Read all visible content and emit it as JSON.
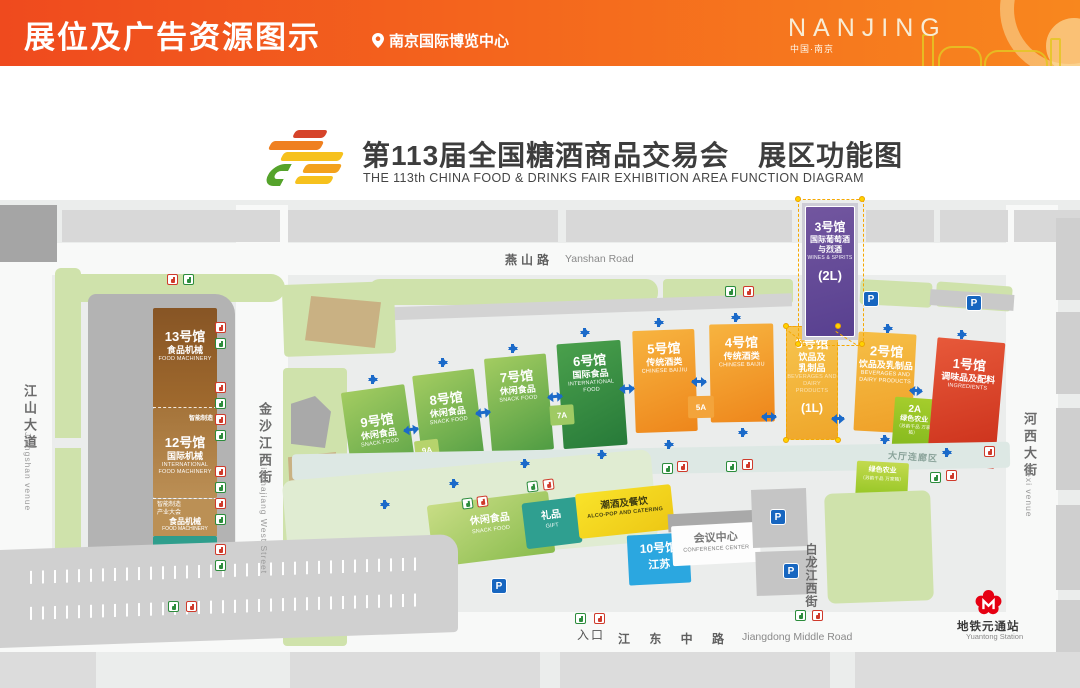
{
  "header": {
    "title": "展位及广告资源图示",
    "venue": "南京国际博览中心",
    "city_en": "NANJING",
    "city_zh": "中国·南京"
  },
  "banner": {
    "title_zh": "第113届全国糖酒商品交易会　展区功能图",
    "title_en": "THE 113th CHINA FOOD & DRINKS FAIR EXHIBITION AREA FUNCTION DIAGRAM"
  },
  "roads": {
    "yanshan_zh": "燕山路",
    "yanshan_en": "Yanshan Road",
    "jiangdong_zh": "江 东 中 路",
    "jiangdong_en": "Jiangdong Middle Road",
    "jiangshan_zh": "江山大道",
    "jiangshan_en": "Jiangshan venue",
    "jinshajiang_zh": "金沙江西街",
    "jinshajiang_en": "Jinshajiang West Street",
    "bailongjiang_zh": "白龙江西街",
    "hexi_zh": "河西大街",
    "hexi_en": "Hexi venue"
  },
  "halls": {
    "h13": {
      "num": "13号馆",
      "zh": "食品机械",
      "en": "FOOD MACHINERY"
    },
    "h12": {
      "num": "12号馆",
      "zh": "国际机械",
      "en1": "INTERNATIONAL",
      "en2": "FOOD MACHINERY",
      "tag_top": "智能制造",
      "tag1": "智能制造",
      "tag2": "产业大会",
      "tag3_zh": "食品机械",
      "tag3_en": "FOOD MACHINERY"
    },
    "h11": {
      "num": "11号馆",
      "zh": "包装及设计",
      "en": "PACKAGING & DESIGN"
    },
    "h9": {
      "num": "9号馆",
      "zh": "休闲食品",
      "en": "SNACK FOOD"
    },
    "h8": {
      "num": "8号馆",
      "zh": "休闲食品",
      "en": "SNACK FOOD"
    },
    "h7": {
      "num": "7号馆",
      "zh": "休闲食品",
      "en": "SNACK FOOD"
    },
    "h6": {
      "num": "6号馆",
      "zh": "国际食品",
      "en1": "INTERNATIONAL",
      "en2": "FOOD"
    },
    "h5": {
      "num": "5号馆",
      "zh": "传统酒类",
      "en": "CHINESE BAIJIU"
    },
    "h4": {
      "num": "4号馆",
      "zh": "传统酒类",
      "en": "CHINESE BAIJIU"
    },
    "h3_1l": {
      "num": "3号馆",
      "zh1": "饮品及",
      "zh2": "乳制品",
      "en1": "BEVERAGES AND",
      "en2": "DAIRY PRODUCTS",
      "level": "(1L)"
    },
    "h3_2l": {
      "num": "3号馆",
      "zh1": "国际葡萄酒",
      "zh2": "与烈酒",
      "en": "WINES & SPIRITS",
      "level": "(2L)"
    },
    "h2": {
      "num": "2号馆",
      "zh": "饮品及乳制品",
      "en1": "BEVERAGES AND",
      "en2": "DAIRY PRODUCTS"
    },
    "h1": {
      "num": "1号馆",
      "zh": "调味品及配料",
      "en": "INGREDIENTS"
    },
    "h10": {
      "num": "10号馆",
      "zh": "江苏"
    },
    "h2a": {
      "num": "2A",
      "zh": "绿色农业",
      "sub": "（苏韵千品 万家箱）"
    },
    "green_agri": {
      "zh": "绿色农业",
      "sub": "（苏韵千品 万家箱）"
    },
    "conference": {
      "zh": "会议中心",
      "en": "CONFERENCE CENTER"
    },
    "gift": {
      "zh": "礼品",
      "en": "GIFT"
    },
    "snack": {
      "zh": "休闲食品",
      "en": "SNACK FOOD"
    },
    "alcopop": {
      "zh": "潮酒及餐饮",
      "en": "ALCO-POP AND CATERING"
    }
  },
  "labels": {
    "entrance": "入口",
    "corridor": "大厅连廊区",
    "parking": "P",
    "a9": "9A",
    "a7": "7A",
    "a5": "5A",
    "metro_zh": "地铁元通站",
    "metro_en": "Yuantong Station"
  }
}
